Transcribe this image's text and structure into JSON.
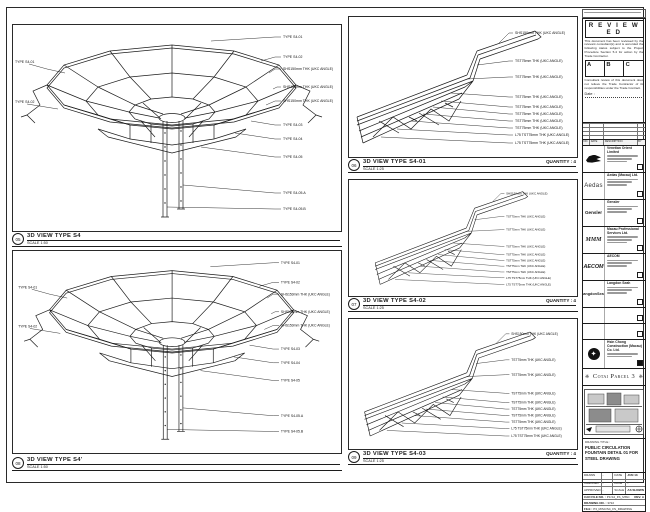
{
  "views": {
    "left_top": {
      "marker": "05",
      "title": "3D VIEW TYPE S4",
      "scale": "SCALE 1:50"
    },
    "left_bottom": {
      "marker": "08",
      "title": "3D VIEW TYPE S4'",
      "scale": "SCALE 1:50"
    },
    "mid": [
      {
        "marker": "06",
        "title": "3D VIEW TYPE S4-01",
        "scale": "SCALE 1:25",
        "quantity": "QUANTITY : 4"
      },
      {
        "marker": "07",
        "title": "3D VIEW TYPE S4-02",
        "scale": "SCALE 1:25",
        "quantity": "QUANTITY : 4"
      },
      {
        "marker": "09",
        "title": "3D VIEW TYPE S4-03",
        "scale": "SCALE 1:25",
        "quantity": "QUANTITY : 4"
      }
    ],
    "left_callouts_right": [
      "TYPE S4-01",
      "TYPE S4-02",
      "SHS150mm THK (UKC ANGLE)",
      "SHS150mm THK (UKC ANGLE)",
      "SHS150mm THK (UKC ANGLE)",
      "TYPE S4-03",
      "TYPE S4-04",
      "TYPE S4-05",
      "TYPE S4-05.A",
      "TYPE S4-05.B"
    ],
    "left_callouts_left": [
      "TYPE S4-01",
      "TYPE S4-02"
    ],
    "mid_callouts": [
      "SHS150mm THK (UKC ANGLE)",
      "TST75mm THK (UKC ANGLE)",
      "TST75mm THK (UKC ANGLE)",
      "TST75mm THK (UKC ANGLE)",
      "TST75mm THK (UKC ANGLE)",
      "TST75mm THK (UKC ANGLE)",
      "TST75mm THK (UKC ANGLE)",
      "TST75mm THK (UKC ANGLE)",
      "L75 TST75mm THK (UKC ANGLE)",
      "L75 TST75mm THK (UKC ANGLE)"
    ]
  },
  "titleblock": {
    "reviewed": {
      "title": "R E V I E W E D",
      "body": "This document has been reviewed by the relevant consultant(s) and is accorded the following status subject to the Project Procedure Section 5.4 for action by the Trade Contractor.",
      "statuses": [
        "A",
        "B",
        "C"
      ],
      "note": "Consultant review of this document does not relieve the Trade Contractor of its responsibilities under the Trade Contract.",
      "date_label": "Date :"
    },
    "rev_table_headers": [
      "NO.",
      "DATE",
      "DESCRIPTION",
      "BY"
    ],
    "consultants": [
      {
        "logo": "",
        "name": "Venetian Orient Limited"
      },
      {
        "logo": "Aedas",
        "name": "Aedas (Macau) Ltd."
      },
      {
        "logo": "Gensler",
        "name": "Gensler"
      },
      {
        "logo": "MMM",
        "name": "Macau Professional Services Ltd."
      },
      {
        "logo": "AECOM",
        "name": "AECOM"
      },
      {
        "logo": "LangdonSeah",
        "name": "Langdon Seah"
      },
      {
        "logo": "",
        "name": ""
      },
      {
        "logo": "",
        "name": ""
      }
    ],
    "contractor": {
      "name": "Hsin Chong Construction (Macau) Co. Ltd."
    },
    "project": "Cotai Parcel 3",
    "banner_ornament": "❈",
    "drawing_title_label": "DRAWING TITLE :",
    "drawing_title": "PUBLIC CIRCULATION FOUNTAIN DETAIL 01 FOR STEEL DRAWING",
    "sign_rows": [
      [
        "DRAWN",
        "-",
        "DATE",
        "JUN 13"
      ],
      [
        "CHECKED",
        "-",
        "DATE",
        "-"
      ],
      [
        "APPROVED",
        "-",
        "SCALE",
        "AS SHOWN"
      ]
    ],
    "cad_file": {
      "label": "CAD FILE NO. :",
      "value": "P3-S4_FS_MISC",
      "rev": "REV. A"
    },
    "drawing_no": {
      "label": "DRAWING NO. :",
      "value": "3722"
    },
    "file_row": {
      "label": "FILE :",
      "value": "P3_MISC/S4_FS_DRAWING"
    }
  }
}
